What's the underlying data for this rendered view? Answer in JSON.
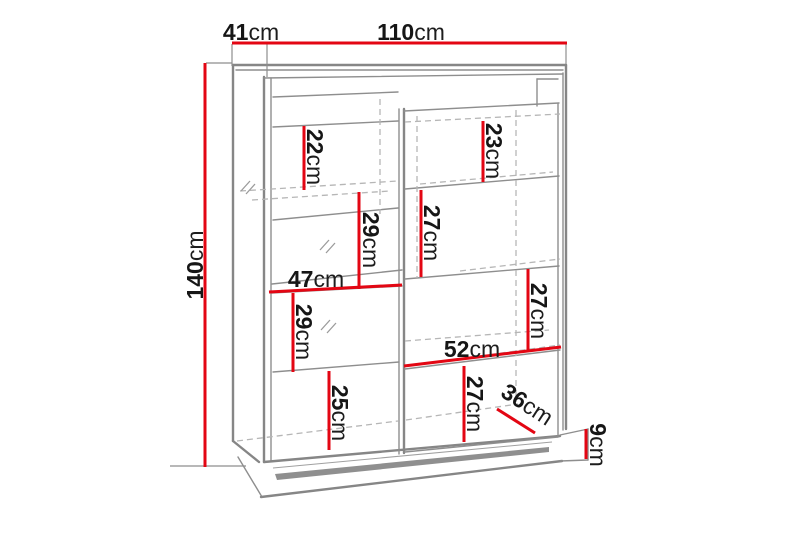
{
  "diagram": {
    "type": "furniture-dimension-drawing",
    "subject": "display cabinet with shelves, glass panels and plinth",
    "unit": "cm",
    "colors": {
      "dimension_line": "#e30613",
      "cabinet_outline": "#868686",
      "hidden_edge": "#b6b6b6",
      "label_text": "#161616",
      "background": "#ffffff"
    }
  },
  "measurements": {
    "depth_top": {
      "value": "41",
      "unit": "cm"
    },
    "width_top": {
      "value": "110",
      "unit": "cm"
    },
    "height_left": {
      "value": "140",
      "unit": "cm"
    },
    "left_shelf_top": {
      "value": "22",
      "unit": "cm"
    },
    "right_shelf_top": {
      "value": "23",
      "unit": "cm"
    },
    "left_shelf_second": {
      "value": "29",
      "unit": "cm"
    },
    "right_shelf_second": {
      "value": "27",
      "unit": "cm"
    },
    "left_section_width": {
      "value": "47",
      "unit": "cm"
    },
    "left_shelf_third": {
      "value": "29",
      "unit": "cm"
    },
    "right_shelf_third": {
      "value": "27",
      "unit": "cm"
    },
    "right_section_width": {
      "value": "52",
      "unit": "cm"
    },
    "right_shelf_bottom": {
      "value": "27",
      "unit": "cm"
    },
    "left_shelf_bottom": {
      "value": "25",
      "unit": "cm"
    },
    "bottom_depth": {
      "value": "36",
      "unit": "cm"
    },
    "plinth_height": {
      "value": "9",
      "unit": "cm"
    }
  }
}
